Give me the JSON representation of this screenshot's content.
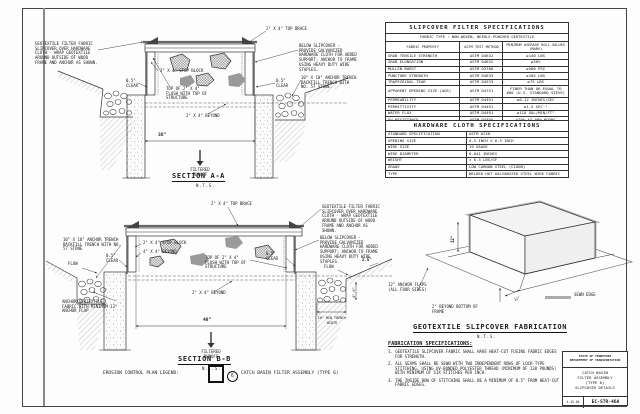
{
  "sheet": {
    "legend": {
      "label": "EROSION CONTROL PLAN LEGEND:",
      "symbol_number": "6",
      "description": "CATCH BASIN FILTER ASSEMBLY (TYPE 6)"
    },
    "title_block": {
      "agency_line1": "STATE OF TENNESSEE",
      "agency_line2": "DEPARTMENT OF TRANSPORTATION",
      "title_line1": "CATCH BASIN",
      "title_line2": "FILTER ASSEMBLY",
      "title_line3": "(TYPE 6)",
      "title_line4": "SLIPCOVER DETAILS",
      "date": "4-15-04",
      "sheet_number": "EC-STR-46A"
    }
  },
  "section_a": {
    "title": "SECTION A-A",
    "scale": "N.T.S.",
    "notes": {
      "slipcover": "GEOTEXTILE FILTER FABRIC SLIPCOVER OVER HARDWARE CLOTH - WRAP GEOTEXTILE AROUND OUTSIDE OF WOOD FRAME AND ANCHOR AS SHOWN.",
      "stop_block": "2\" X 4\" STOP BLOCK",
      "clear_left": "0.5\" CLEAR",
      "flush": "TOP OF 2\" X 4\" FLUSH WITH TOP OF STRUCTURE",
      "top_brace": "2\" X 4\" TOP BRACE",
      "below_slipcover": "BELOW SLIPCOVER - PROVIDE GALVANIZED HARDWARE CLOTH FOR ADDED SUPPORT; ANCHOR TO FRAME USING HEAVY DUTY WIRE STAPLES.",
      "anchor_trench": "10\" X 10\" ANCHOR TRENCH BACKFILL TRENCH WITH NO. 57 STONE.",
      "clear_right": "0.5\" CLEAR",
      "beyond": "2\" X 4\" BEYOND"
    },
    "dims": {
      "width": "36\""
    },
    "runoff": "FILTERED RUNOFF"
  },
  "section_b": {
    "title": "SECTION B-B",
    "scale": "N.T.S.",
    "notes": {
      "anchor_trench": "10\" X 10\" ANCHOR TRENCH BACKFILL TRENCH WITH NO. 57 STONE",
      "flow_left": "FLOW",
      "clear_left": "0.5\" CLEAR",
      "stop_block": "2\" X 4\" STOP BLOCK",
      "beyond_4x4": "4\" X 4\" BEYOND",
      "top_brace": "2\" X 4\" TOP BRACE",
      "slipcover": "GEOTEXTILE FILTER FABRIC SLIPCOVER OVER HARDWARE CLOTH - WRAP GEOTEXTILE AROUND OUTSIDE OF WOOD FRAME AND ANCHOR AS SHOWN.",
      "below_slipcover": "BELOW SLIPCOVER - PROVIDE GALVANIZED HARDWARE CLOTH FOR ADDED SUPPORT; ANCHOR TO FRAME USING HEAVY DUTY WIRE STAPLES.",
      "flush": "TOP OF 2\" X 4\" FLUSH WITH TOP OF STRUCTURE",
      "clear_right": "0.5\" CLEAR",
      "flow_right": "FLOW",
      "anchor_flap": "ANCHOR GEOTEXTILE FABRIC WITH MINIMUM 12\" ANCHOR FLAP",
      "beyond": "2\" X 4\" BEYOND",
      "trench_width": "10\" MIN TRENCH WIDTH"
    },
    "dims": {
      "width": "48\"",
      "step": "2.5\"",
      "depth": "4\"-6\""
    },
    "runoff": "FILTERED RUNOFF"
  },
  "fabrication": {
    "title": "GEOTEXTILE SLIPCOVER FABRICATION",
    "scale": "N.T.S.",
    "labels": {
      "anchor_flaps": "12\" ANCHOR FLAPS (ALL FOUR SIDES)",
      "sewn_edge": "SEWN EDGE",
      "beyond_bottom": "2\" BEYOND BOTTOM OF FRAME",
      "height_dim": "12\"",
      "flap_dim": "12\""
    },
    "spec_heading": "FABRICATION SPECIFICATIONS:",
    "notes": [
      "1. GEOTEXTILE SLIPCOVER FABRIC SHALL HAVE HEAT-CUT FUSING FABRIC EDGES FOR STRENGTH.",
      "2. ALL SEAMS SHALL BE SEWN WITH TWO INDEPENDENT ROWS OF LOCK-TYPE STITCHING, USING UV-BONDED POLYESTER THREAD (MINIMUM OF 130 POUNDS) WITH MINIMUM OF SIX STITCHES PER INCH.",
      "3. THE INSIDE ROW OF STITCHING SHALL BE A MINIMUM OF 0.5\" FROM HEAT-CUT FABRIC EDGES."
    ]
  },
  "filter_spec_table": {
    "title": "SLIPCOVER FILTER SPECIFICATIONS",
    "subtitle": "FABRIC TYPE : NON-WOVEN, NEEDLE-PUNCHED GEOTEXTILE",
    "headers": {
      "property": "FABRIC PROPERTY",
      "method": "ASTM TEST METHOD",
      "value": "MINIMUM AVERAGE ROLL VALUES (MARV)"
    },
    "rows": [
      {
        "property": "GRAB TENSILE STRENGTH",
        "method": "ASTM D4632",
        "value": "≥140 LBS"
      },
      {
        "property": "GRAB ELONGATION",
        "method": "ASTM D4632",
        "value": "≥50%"
      },
      {
        "property": "MULLEN BURST",
        "method": "ASTM D3786",
        "value": "≥500 PSI"
      },
      {
        "property": "PUNCTURE STRENGTH",
        "method": "ASTM D4833",
        "value": "≥105 LBS"
      },
      {
        "property": "TRAPEZOIDAL TEAR",
        "method": "ASTM D4533",
        "value": "≥75 LBS"
      },
      {
        "property": "APPARENT OPENING SIZE (AOS)",
        "method": "ASTM D4751",
        "value": "FINER THAN OR EQUAL TO #80 (U.S. STANDARD SIEVE)"
      },
      {
        "property": "PERMEABILITY",
        "method": "ASTM D4491",
        "value": "≥0.12 INCHES/SEC"
      },
      {
        "property": "PERMITTIVITY",
        "method": "ASTM D4491",
        "value": "≥1.5 SEC⁻¹"
      },
      {
        "property": "WATER FLUX",
        "method": "ASTM D4491",
        "value": "≥110 GAL/MIN/FT²"
      },
      {
        "property": "UV RESISTANCE",
        "method": "ASTM D4355",
        "value": "≥70% AT 500 HOURS"
      },
      {
        "property": "WEIGHT",
        "method": "ASTM D3776",
        "value": "MINIMUM 6 OZ/YD²"
      }
    ]
  },
  "hardware_cloth_table": {
    "title": "HARDWARE CLOTH SPECIFICATIONS",
    "rows": [
      {
        "property": "STANDARD SPECIFICATION",
        "value": "ASTM A740"
      },
      {
        "property": "OPENING SIZE",
        "value": "0.5 INCH X 0.5 INCH"
      },
      {
        "property": "WIRE SIZE",
        "value": "19 GAUGE"
      },
      {
        "property": "WIRE DIAMETER",
        "value": "0.041 INCHES"
      },
      {
        "property": "WEIGHT",
        "value": "± 0.3 LBS/SF"
      },
      {
        "property": "GRADE",
        "value": "LOW CARBON STEEL (C1008)"
      },
      {
        "property": "TYPE",
        "value": "WELDED HOT GALVANIZED STEEL WIRE FABRIC"
      }
    ]
  }
}
